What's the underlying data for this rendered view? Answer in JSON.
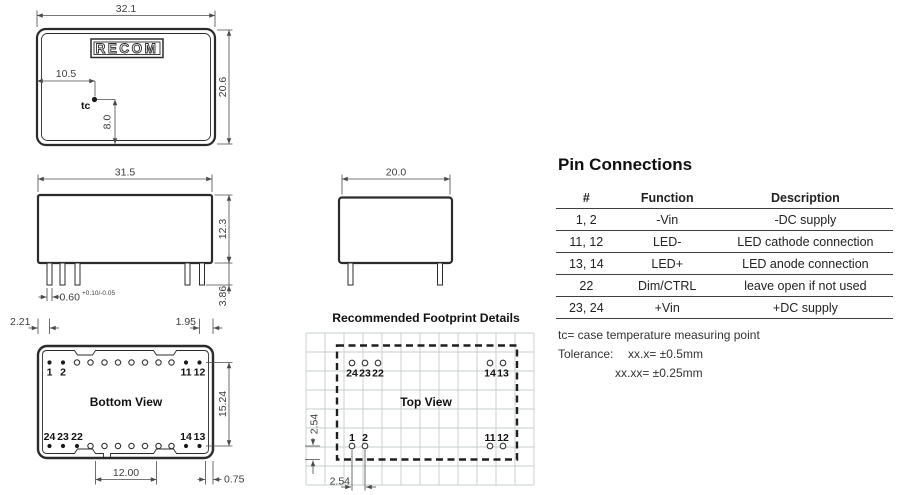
{
  "style": {
    "line_color": "#2b2b2b",
    "dim_color": "#4a4a4a",
    "grid_color": "#c6ccce",
    "text_color": "#1a1a1a"
  },
  "top_view": {
    "logo": "RECOM",
    "tc_label": "tc",
    "width": "32.1",
    "height": "20.6",
    "tc_offset_x": "10.5",
    "tc_offset_y": "8.0"
  },
  "front_view": {
    "width": "31.5",
    "height": "12.3",
    "pin_width": "0.60",
    "pin_width_tol": "+0.10/-0.05",
    "pin_length": "3.86"
  },
  "end_view": {
    "width": "20.0"
  },
  "bottom_view": {
    "title": "Bottom View",
    "pin_edge_left": "2.21",
    "pin_edge_right": "1.95",
    "row_spacing": "15.24",
    "notch_spacing": "12.00",
    "edge_offset": "0.75",
    "pins_top_left": [
      "1",
      "2"
    ],
    "pins_top_right": [
      "11",
      "12"
    ],
    "pins_bottom_left": [
      "24",
      "23",
      "22"
    ],
    "pins_bottom_right": [
      "14",
      "13"
    ]
  },
  "footprint": {
    "section_title": "Recommended Footprint Details",
    "title": "Top View",
    "pitch_vertical": "2.54",
    "pitch_horizontal": "2.54",
    "pins_top_left": [
      "24",
      "23",
      "22"
    ],
    "pins_top_right": [
      "14",
      "13"
    ],
    "pins_bottom_left": [
      "1",
      "2"
    ],
    "pins_bottom_right": [
      "11",
      "12"
    ]
  },
  "pin_table": {
    "title": "Pin Connections",
    "headers": [
      "#",
      "Function",
      "Description"
    ],
    "rows": [
      [
        "1, 2",
        "-Vin",
        "-DC supply"
      ],
      [
        "11, 12",
        "LED-",
        "LED cathode connection"
      ],
      [
        "13, 14",
        "LED+",
        "LED anode connection"
      ],
      [
        "22",
        "Dim/CTRL",
        "leave open if not used"
      ],
      [
        "23, 24",
        "+Vin",
        "+DC supply"
      ]
    ]
  },
  "notes": {
    "note_tc": "tc= case temperature measuring point",
    "tolerance_label": "Tolerance:",
    "tolerance_1": "xx.x= ±0.5mm",
    "tolerance_2": "xx.xx= ±0.25mm"
  }
}
